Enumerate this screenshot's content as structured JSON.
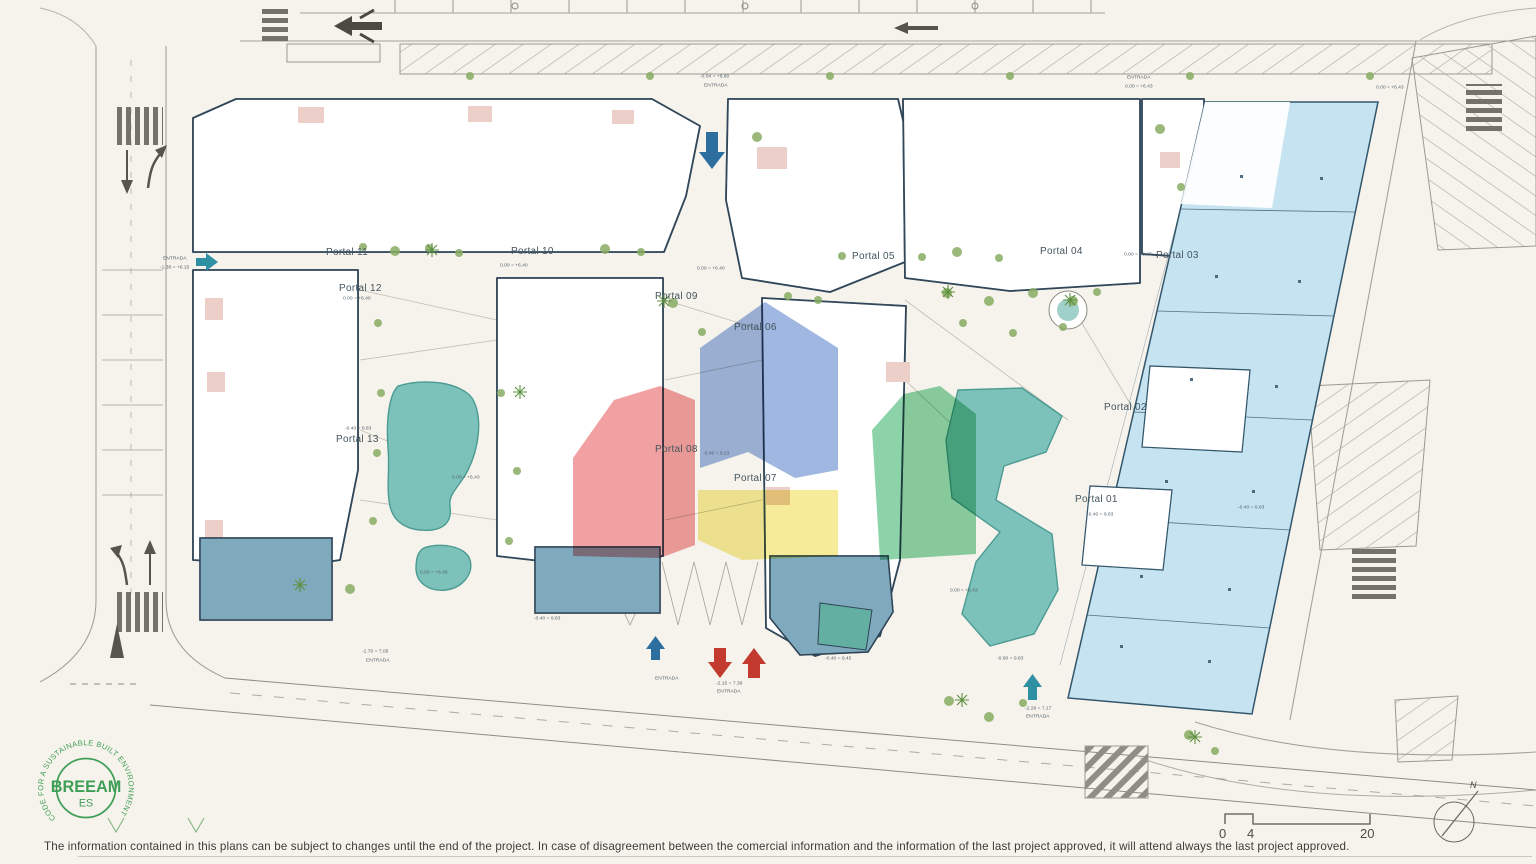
{
  "portals": [
    {
      "label": "Portal 11",
      "x": 326,
      "y": 247
    },
    {
      "label": "Portal 10",
      "x": 511,
      "y": 246
    },
    {
      "label": "Portal 12",
      "x": 339,
      "y": 283
    },
    {
      "label": "Portal 09",
      "x": 655,
      "y": 291
    },
    {
      "label": "Portal 05",
      "x": 852,
      "y": 251
    },
    {
      "label": "Portal 06",
      "x": 734,
      "y": 322
    },
    {
      "label": "Portal 04",
      "x": 1040,
      "y": 246
    },
    {
      "label": "Portal 03",
      "x": 1156,
      "y": 250
    },
    {
      "label": "Portal 02",
      "x": 1104,
      "y": 402
    },
    {
      "label": "Portal 01",
      "x": 1075,
      "y": 494
    },
    {
      "label": "Portal 13",
      "x": 336,
      "y": 434
    },
    {
      "label": "Portal 08",
      "x": 655,
      "y": 444
    },
    {
      "label": "Portal 07",
      "x": 734,
      "y": 473
    }
  ],
  "annotations": [
    {
      "text": "-0.04 = +6.80",
      "x": 700,
      "y": 74
    },
    {
      "text": "ENTRADA",
      "x": 704,
      "y": 83
    },
    {
      "text": "ENTRADA",
      "x": 1127,
      "y": 75
    },
    {
      "text": "0.00 = +6.43",
      "x": 1125,
      "y": 84
    },
    {
      "text": "0.00 = +6.43",
      "x": 1376,
      "y": 85
    },
    {
      "text": "ENTRADA",
      "x": 163,
      "y": 256
    },
    {
      "text": "-1.38 = +6.15",
      "x": 160,
      "y": 265
    },
    {
      "text": "0.00 = +6.40",
      "x": 343,
      "y": 296
    },
    {
      "text": "0.00 = +6.40",
      "x": 500,
      "y": 263
    },
    {
      "text": "0.00 = +6.40",
      "x": 697,
      "y": 266
    },
    {
      "text": "0.00 = +6.43",
      "x": 1124,
      "y": 252
    },
    {
      "text": "-0.40 = 9.83",
      "x": 345,
      "y": 426
    },
    {
      "text": "-0.40 = 9.23",
      "x": 703,
      "y": 451
    },
    {
      "text": "0.00 = +6.43",
      "x": 452,
      "y": 475
    },
    {
      "text": "0.00 = +6.45",
      "x": 420,
      "y": 570
    },
    {
      "text": "0.00 = +6.43",
      "x": 950,
      "y": 588
    },
    {
      "text": "-0.40 = 9.83",
      "x": 1087,
      "y": 512
    },
    {
      "text": "-0.40 = 9.83",
      "x": 1238,
      "y": 505
    },
    {
      "text": "-0.40 = 9.83",
      "x": 534,
      "y": 616
    },
    {
      "text": "-1.70 = 7.05",
      "x": 362,
      "y": 649
    },
    {
      "text": "ENTRADA",
      "x": 366,
      "y": 658
    },
    {
      "text": "ENTRADA",
      "x": 655,
      "y": 676
    },
    {
      "text": "-2.15 = 7.38",
      "x": 716,
      "y": 681
    },
    {
      "text": "ENTRADA",
      "x": 717,
      "y": 689
    },
    {
      "text": "-0.40 = 9.45",
      "x": 825,
      "y": 656
    },
    {
      "text": "-0.90 = 9.83",
      "x": 997,
      "y": 656
    },
    {
      "text": "-2.28 = 7.17",
      "x": 1025,
      "y": 706
    },
    {
      "text": "ENTRADA",
      "x": 1026,
      "y": 714
    }
  ],
  "scale": {
    "ticks": [
      {
        "label": "0",
        "x": 1219,
        "y": 826
      },
      {
        "label": "4",
        "x": 1247,
        "y": 826
      },
      {
        "label": "20",
        "x": 1360,
        "y": 826
      }
    ]
  },
  "compass": {
    "north_label": "N"
  },
  "logo": {
    "ring_text": "CODE FOR A SUSTAINABLE BUILT ENVIRONMENT",
    "title": "BREEAM",
    "subtitle": "ES"
  },
  "footer": {
    "disclaimer": "The information contained in this plans can be subject to changes until the end of the project. In case of disagreement between the comercial information and the information of the last project approved, it will attend always the last project approved."
  },
  "colors": {
    "overlay_red": "#e54b4b",
    "overlay_blue": "#3f6fc4",
    "overlay_green": "#2fae62",
    "overlay_yellow": "#efdd55",
    "pool": "#7cc2ba",
    "commercial_fill": "#c5e3f0",
    "communal_fill": "#7fa9bc",
    "logo_green": "#3f9e56",
    "arrow_red": "#c23b2e",
    "arrow_blue": "#2c6e9e",
    "arrow_teal": "#2f8fa3",
    "paper": "#f6f3ec",
    "ink": "#31475a"
  }
}
